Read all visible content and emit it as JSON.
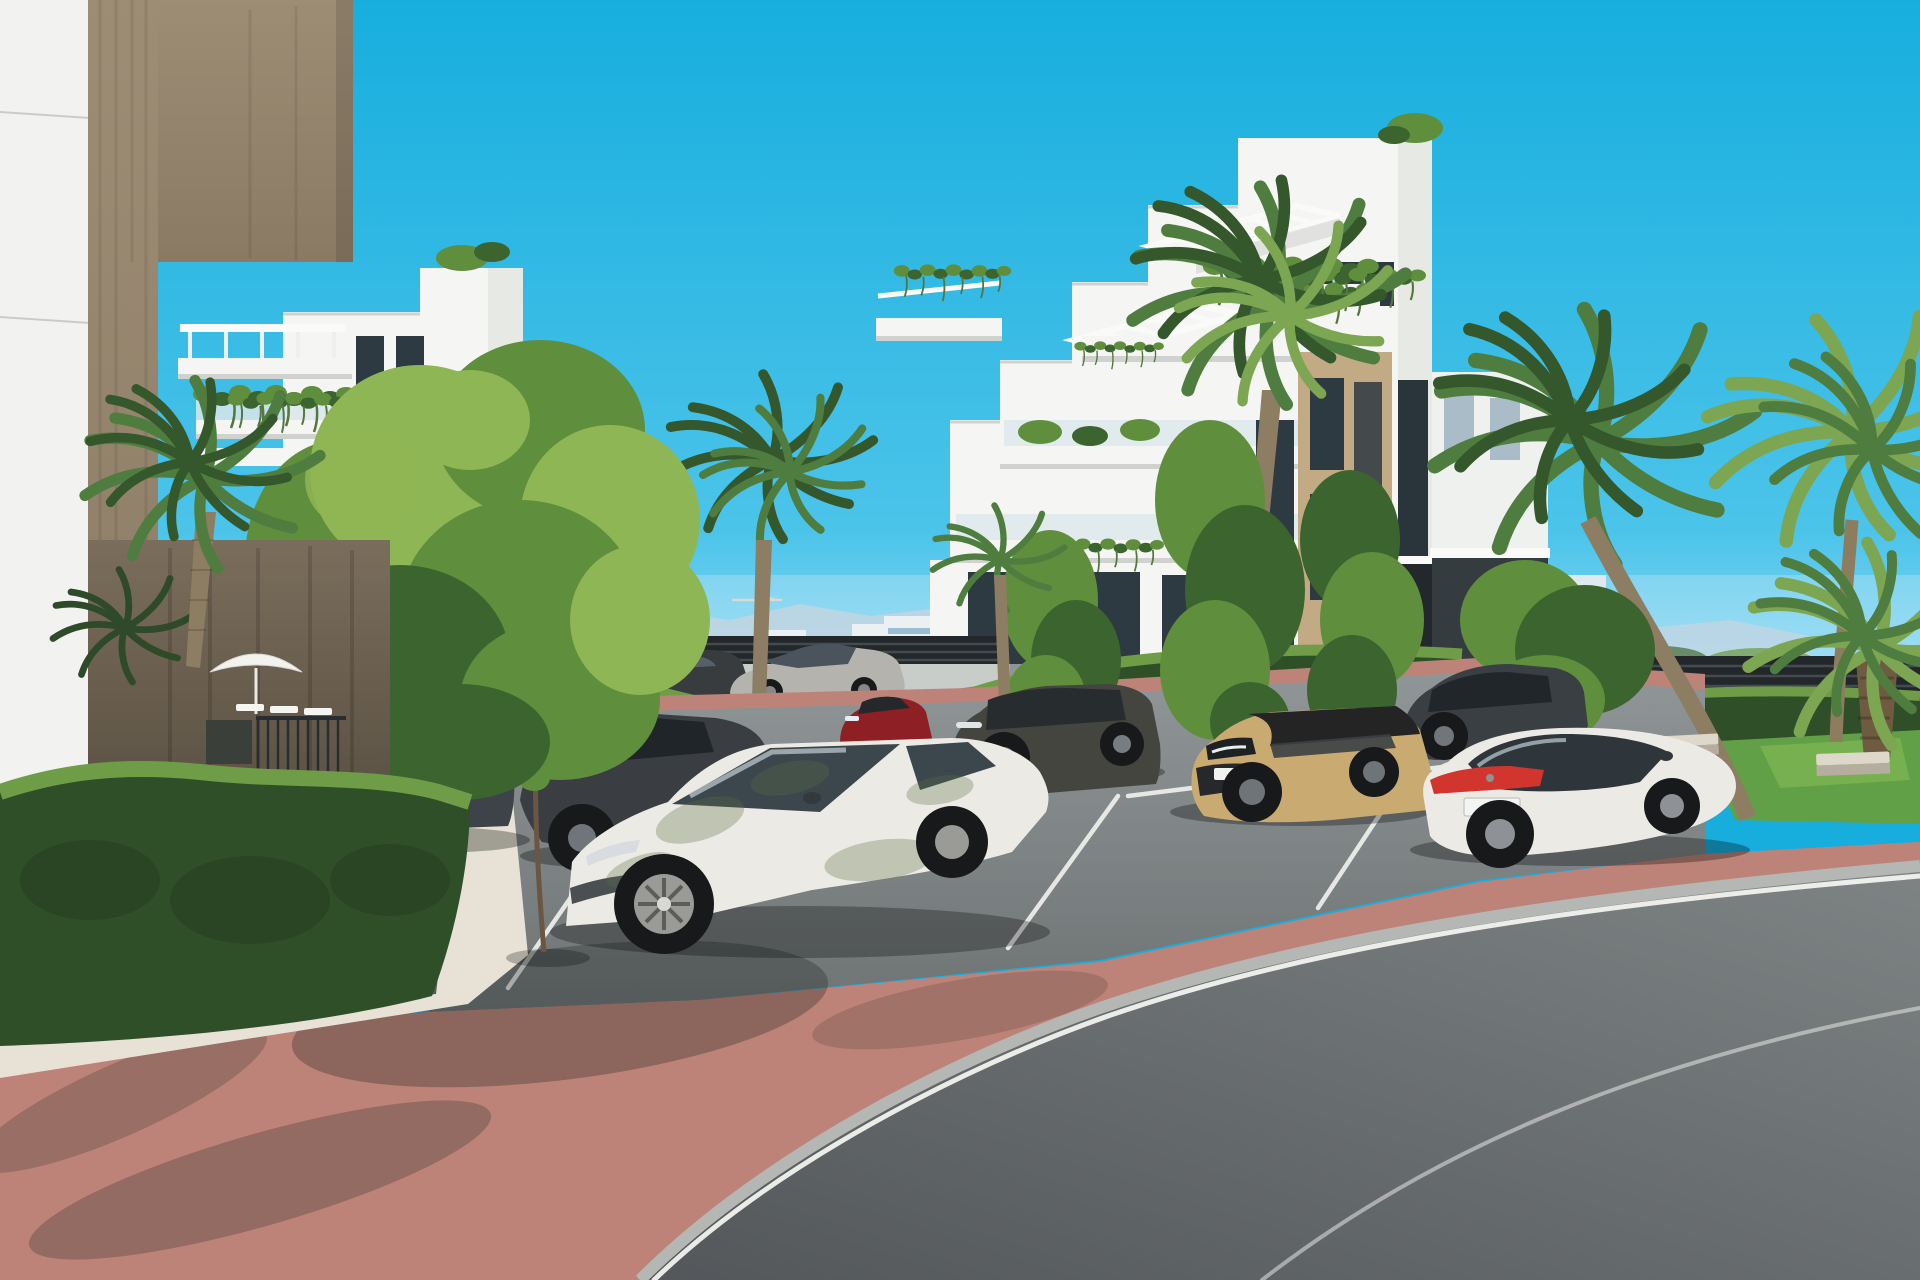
{
  "scene": {
    "type": "3d-architectural-rendering",
    "subject": "Modern white apartment complex with landscaped parking area, palm trees, clipped hedges and parked cars on a sunny day",
    "sky": "clear cyan-blue",
    "visible_text": "none (license plates illegible)"
  },
  "palette": {
    "sky_top": "#17aede",
    "sky_mid": "#4cc4ea",
    "sky_low": "#a8e1f5",
    "haze": "#dff2fa",
    "mountain": "#b6cbd9",
    "town_white": "#f0f2f0",
    "town_shade": "#e2e7e6",
    "town_glass": "#7fa9c2",
    "town_brown": "#8f6750",
    "crane": "#d8cfc0",
    "white": "#f5f6f3",
    "white_shade": "#e7e9e5",
    "parapet_shadow": "#cfd2ce",
    "tan": "#c2aa85",
    "pillar_top": "#9d8d75",
    "pillar_side": "#8a7a64",
    "pillar_low1": "#7a6d5b",
    "pillar_low2": "#4e463a",
    "glass": "#2e3a42",
    "glass_light": "#a9bcc7",
    "balustrade": "#d9e6ea",
    "pergola": "#fafbf9",
    "vine_light": "#8fae6a",
    "vine_dark": "#55763f",
    "tree_light": "#8fb654",
    "tree_mid": "#5f8f3c",
    "tree_dark": "#3c642e",
    "trunk": "#5d4a38",
    "palm_green": "#4f7d3f",
    "palm_light": "#7da653",
    "palm_dark": "#35572c",
    "palm_trunk": "#8d7d62",
    "hedge_top": "#6f9c46",
    "hedge_mid": "#3b5e31",
    "hedge_face": "#2f4f28",
    "lawn": "#61a046",
    "lawn_light": "#83bb55",
    "asphalt_top": "#909697",
    "asphalt_bot": "#6e7374",
    "road_dark": "#53575a",
    "road_light": "#7e8384",
    "brick": "#bd8378",
    "brick_light": "#cfa08f",
    "brick_shade": "#8a6467",
    "gravel": "#e7e2d5",
    "curb": "#b4b7b3",
    "line": "#f2f3ef",
    "fence": "#23272a",
    "fence_light": "#434b51",
    "wall": "#c9cdca",
    "stone_bench_top": "#ddd8ca",
    "stone_bench_front": "#b5ae9e",
    "shadow": "#1c2520",
    "car_silver": "#b4b3ae",
    "car_white": "#eceae4",
    "car_dark1": "#3e434a",
    "car_dark2": "#3a3e42",
    "car_dark3": "#3a3f44",
    "car_red": "#8e2025",
    "car_sand": "#c9aa70",
    "car_grey": "#45453f",
    "tail_red": "#d2342e",
    "glass_car": "#3c464d",
    "wheel_dark": "#17191b",
    "rim": "#9a9a96"
  },
  "objects": {
    "foreground_building": {
      "label": "foreground building corner with travertine stone pier and white panel wall"
    },
    "left_building": {
      "label": "white four-storey apartment block with rooftop pergola, planted balcony and stone accents"
    },
    "right_building": {
      "label": "white stepped apartment block with slatted pergolas, hanging plants, stone feature wall and glazed stairwell"
    },
    "right_annex": {
      "label": "white annex wing with dark glazed ground floor"
    },
    "background": {
      "mountains": "hazy blue mountain ridge",
      "town": "distant low-rise white town with scattered blue-glass and brown buildings",
      "crane": "small construction crane on the skyline",
      "right_glimpse": "distant buildings and greenery seen over a slatted fence"
    },
    "amenities": {
      "parasol": "white garden parasol by the pool terrace",
      "loungers": "white sun loungers",
      "railing": "dark metal pool railing and planter",
      "benches": "two stone benches on the lawn",
      "fence": "dark slatted perimeter fence",
      "wall": "light boundary wall behind the hedge"
    },
    "vehicles": [
      {
        "id": "road-sedan",
        "label": "silver sedan driving on the rear road",
        "color": "#b4b3ae"
      },
      {
        "id": "distant-dark-car",
        "label": "dark car on the rear road",
        "color": "#383c3f"
      },
      {
        "id": "hatchback-left",
        "label": "dark grey hatchback parked at the left",
        "color": "#3e434a"
      },
      {
        "id": "sedan-left",
        "label": "dark grey sedan parked at the left",
        "color": "#3a3e42"
      },
      {
        "id": "white-suv",
        "label": "white SUV coupe parked in the centre with leaf shadows",
        "color": "#eceae4"
      },
      {
        "id": "red-crossover",
        "label": "dark red crossover parked by the hedge",
        "color": "#8e2025"
      },
      {
        "id": "grey-suv",
        "label": "large grey SUV parked centre-right",
        "color": "#45453f"
      },
      {
        "id": "dark-suv-right",
        "label": "dark grey SUV parked near the building entrance",
        "color": "#3a3f44"
      },
      {
        "id": "sand-crossover",
        "label": "sand-beige compact crossover with black roof",
        "color": "#c9aa70"
      },
      {
        "id": "white-sedan",
        "label": "white luxury sedan with full-width red tail light",
        "color": "#ecebe8"
      }
    ],
    "vegetation": {
      "palms": "fan and feather palms around the buildings",
      "trees": "bright green deciduous trees between parking bays",
      "hedges": "clipped box hedges along paths and parking",
      "lawn": "small lawn with palms on the right",
      "balcony_plants": "hanging plants on balcony parapets"
    },
    "ground": {
      "parking": "grey asphalt parking bays with white markings",
      "walkway": "red-brick paving in the foreground and behind the bays",
      "gravel": "white decorative gravel strip along the hedge",
      "road": "curved grey asphalt road with light kerb and white edge lines"
    }
  }
}
